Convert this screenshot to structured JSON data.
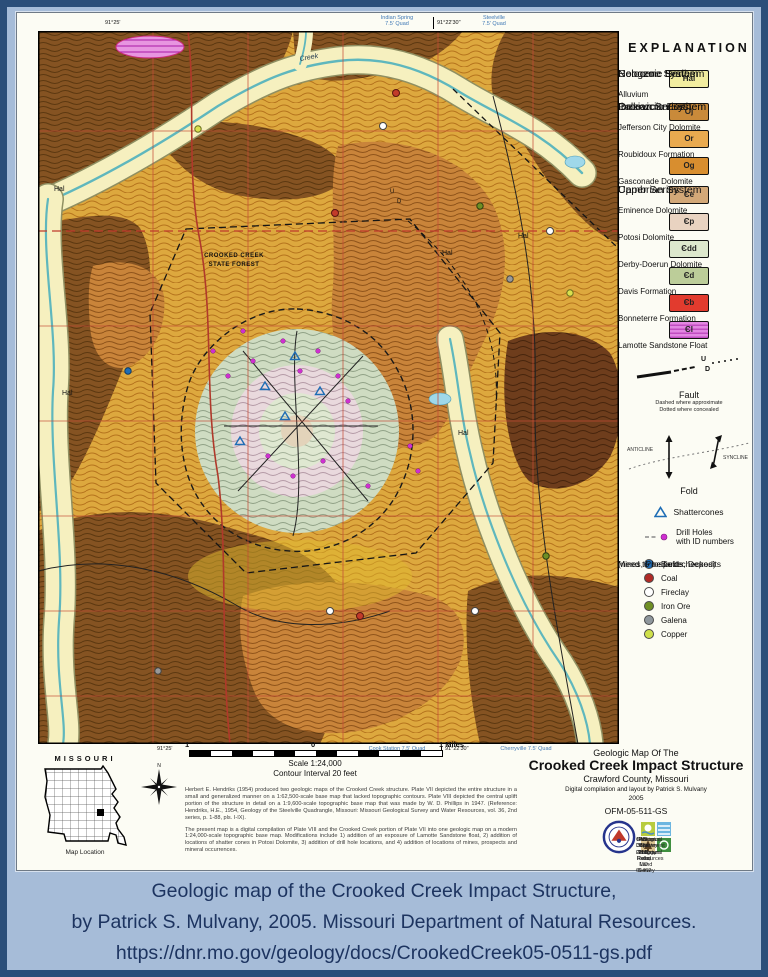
{
  "colors": {
    "page_border": "#2b4e79",
    "page_background": "#a6bcd8",
    "caption_text": "#1d3460",
    "alluvium": "#f6f0bf",
    "stream_blue": "#5fb7bd",
    "section_line_red": "#c44a36"
  },
  "caption": {
    "line1": "Geologic map of the Crooked Creek Impact Structure,",
    "line2": "by Patrick S. Mulvany, 2005. Missouri Department of Natural Resources.",
    "line3": "https://dnr.mo.gov/geology/docs/CrookedCreek05-0511-gs.pdf"
  },
  "explanation": {
    "title": "EXPLANATION",
    "groups": [
      {
        "heading": [
          "Cenozoic Erathem",
          "Neogene System",
          "Holocene Series"
        ],
        "units": [
          {
            "code": "Hal",
            "color": "#f2eda0",
            "label": "Alluvium"
          }
        ]
      },
      {
        "heading": [
          "Paleozoic Erathem",
          "Ordovician System",
          "Ibexian Series"
        ],
        "units": [
          {
            "code": "Oj",
            "color": "#c98a3a",
            "label": "Jefferson City Dolomite"
          },
          {
            "code": "Or",
            "color": "#e9aa4f",
            "label": "Roubidoux Formation"
          },
          {
            "code": "Og",
            "color": "#d88e2f",
            "label": "Gasconade Dolomite"
          }
        ]
      },
      {
        "heading": [
          "Cambrian System",
          "Upper Series"
        ],
        "units": [
          {
            "code": "Єe",
            "color": "#d3a878",
            "label": "Eminence Dolomite"
          },
          {
            "code": "Єp",
            "color": "#e9d3c1",
            "label": "Potosi Dolomite"
          },
          {
            "code": "Єdd",
            "color": "#dde8cd",
            "label": "Derby-Doerun Dolomite"
          },
          {
            "code": "Єd",
            "color": "#bccd99",
            "label": "Davis Formation"
          },
          {
            "code": "Єb",
            "color": "#e23b2e",
            "label": "Bonneterre Formation"
          },
          {
            "code": "Єl",
            "color": "#e387e3",
            "label": "Lamotte Sandstone Float"
          }
        ]
      }
    ],
    "fault": {
      "label": "Fault",
      "sub1": "Dashed where approximate",
      "sub2": "Dotted where concealed",
      "u": "U",
      "d": "D"
    },
    "fold": {
      "label": "Fold",
      "anticline": "ANTICLINE",
      "syncline": "SYNCLINE"
    },
    "shatter": {
      "label": "Shattercones"
    },
    "drill": {
      "line1": "Drill Holes",
      "line2": "with ID numbers"
    },
    "mines": {
      "heading1": "Mines, Prospects, Deposits",
      "heading2": "(need to be field checked)",
      "items": [
        {
          "label": "Barite",
          "color": "#1e6db5"
        },
        {
          "label": "Coal",
          "color": "#b02a25"
        },
        {
          "label": "Fireclay",
          "color": "#ffffff"
        },
        {
          "label": "Iron Ore",
          "color": "#6f8f24"
        },
        {
          "label": "Galena",
          "color": "#8f979d"
        },
        {
          "label": "Copper",
          "color": "#cfe04a"
        }
      ]
    }
  },
  "titleblock": {
    "line1": "Geologic Map Of The",
    "title": "Crooked Creek Impact Structure",
    "county": "Crawford County, Missouri",
    "credit": "Digital compilation and layout by Patrick S. Mulvany",
    "year": "2005",
    "number": "OFM-05-511-GS",
    "org1": "Missouri Department of Natural Resources",
    "org2": "Division of Geology and Land Survey",
    "org3": "Geological Survey Program",
    "org4": "P.O. Box 250, Rolla, MO 65402",
    "phone": "573-368-2100"
  },
  "scalebar": {
    "left": "1",
    "mid": "0",
    "right": "1 Miles",
    "scale": "Scale 1:24,000",
    "contour": "Contour Interval 20 feet"
  },
  "notes": {
    "para1": "Herbert E. Hendriks (1954) produced two geologic maps of the Crooked Creek structure. Plate VII depicted the entire structure in a small and generalized manner on a 1:62,500-scale base map that lacked topographic contours. Plate VIII depicted the central uplift portion of the structure in detail on a 1:9,600-scale topographic base map that was made by W. D. Phillips in 1947. (Reference: Hendriks, H.E., 1954, Geology of the Steelville Quadrangle, Missouri: Missouri Geological Survey and Water Resources, vol. 36, 2nd series, p. 1-88, pls. I-IX).",
    "para2": "The present map is a digital compilation of Plate VIII and the Crooked Creek portion of Plate VII into one geologic map on a modern 1:24,000-scale topographic base map. Modifications include 1) addition of an exposure of Lamotte Sandstone float, 2) addition of locations of shatter cones in Potosi Dolomite, 3) addition of drill hole locations, and 4) addition of locations of mines, prospects and mineral occurrences."
  },
  "inset": {
    "title": "MISSOURI",
    "caption": "Map Location"
  },
  "edges": {
    "top_left_coord": "91°25'",
    "top_quad1_name": "Indian Spring",
    "top_quad1_sub": "7.5' Quad",
    "top_coord": "91°22'30\"",
    "top_quad2_name": "Steelville",
    "top_quad2_sub": "7.5' Quad",
    "bottom_left_coord": "91°25'",
    "bottom_quad1": "Cook Station 7.5' Quad",
    "bottom_coord": "91°22'30\"",
    "bottom_quad2": "Cherryville 7.5' Quad"
  },
  "map": {
    "labels": {
      "hal": "Hal",
      "forest1": "CROOKED CREEK",
      "forest2": "STATE FOREST",
      "creek": "Creek",
      "u": "U",
      "d": "D"
    }
  }
}
